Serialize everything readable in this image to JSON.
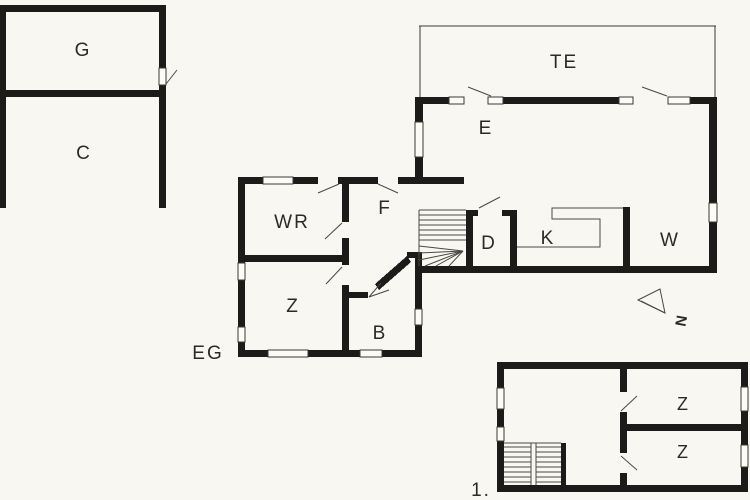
{
  "palette": {
    "background": "#f8f7f1",
    "wall": "#1c1b19",
    "thin_line": "#3a3833",
    "window": "#fcfbf6"
  },
  "plans": {
    "garage": {
      "rooms": {
        "g": "G",
        "c": "C"
      }
    },
    "ground_floor": {
      "label": "EG",
      "rooms": {
        "te": "TE",
        "e": "E",
        "wr": "WR",
        "f": "F",
        "z": "Z",
        "b": "B",
        "d": "D",
        "k": "K",
        "w": "W"
      }
    },
    "upper_floor": {
      "label": "1.",
      "rooms": {
        "z_top": "Z",
        "z_bottom": "Z"
      }
    }
  },
  "compass": {
    "north": "N"
  }
}
